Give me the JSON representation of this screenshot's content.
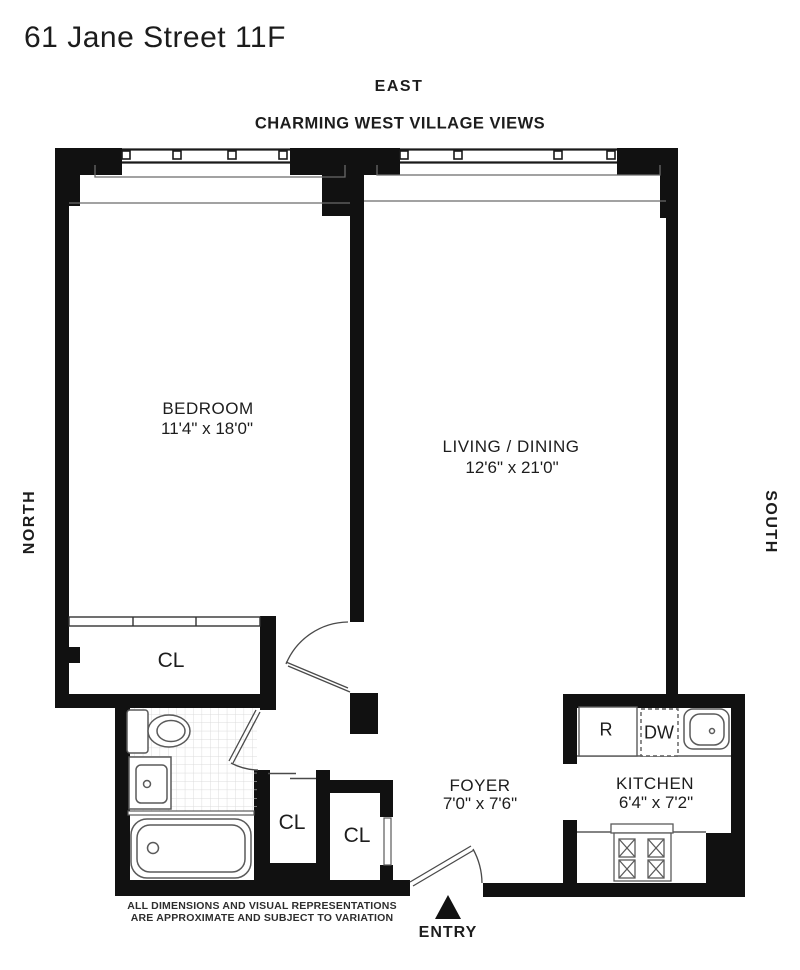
{
  "title": "61 Jane Street 11F",
  "subtitle": "CHARMING WEST VILLAGE VIEWS",
  "compass": {
    "east": "EAST",
    "north": "NORTH",
    "south": "SOUTH"
  },
  "rooms": {
    "bedroom": {
      "name": "BEDROOM",
      "dims": "11'4\" x 18'0\""
    },
    "living_dining": {
      "name": "LIVING / DINING",
      "dims": "12'6\" x 21'0\""
    },
    "foyer": {
      "name": "FOYER",
      "dims": "7'0\" x 7'6\""
    },
    "kitchen": {
      "name": "KITCHEN",
      "dims": "6'4\" x 7'2\""
    }
  },
  "closets": {
    "bedroom_closet": "CL",
    "foyer_closet_1": "CL",
    "foyer_closet_2": "CL"
  },
  "appliances": {
    "refrigerator": "R",
    "dishwasher": "DW"
  },
  "entry": {
    "label": "ENTRY"
  },
  "disclaimer": {
    "line1": "ALL DIMENSIONS AND VISUAL REPRESENTATIONS",
    "line2": "ARE APPROXIMATE AND SUBJECT TO VARIATION"
  },
  "colors": {
    "wall": "#111111",
    "fixture_line": "#5a5a5a",
    "tile_line": "#dcdcdc",
    "text": "#1d1d1d",
    "background": "#ffffff"
  }
}
